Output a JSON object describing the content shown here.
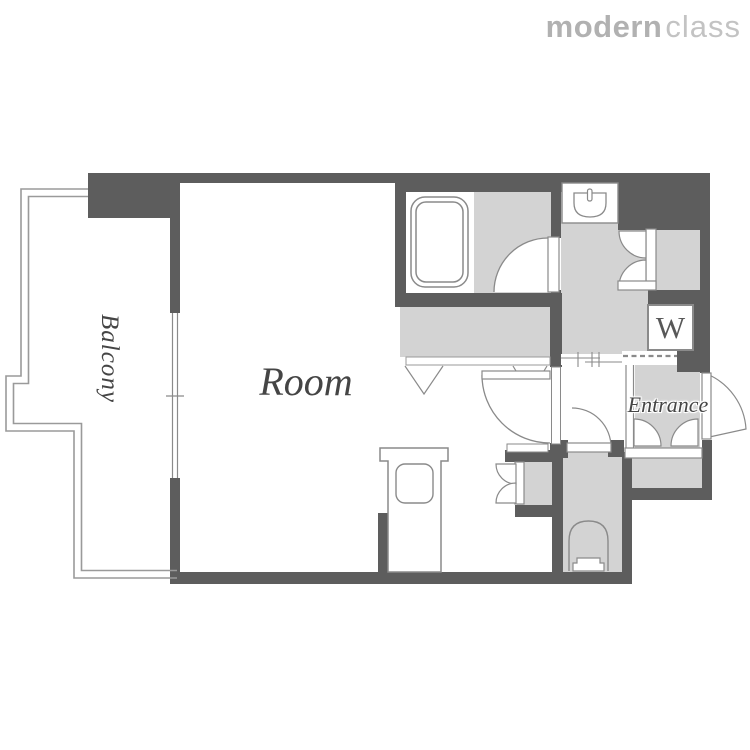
{
  "brand": {
    "bold": "modern",
    "light": "class"
  },
  "floorplan": {
    "labels": {
      "room": "Room",
      "balcony": "Balcony",
      "entrance": "Entrance",
      "washer": "W"
    },
    "colors": {
      "wall": "#5d5d5d",
      "floor": "#d3d3d3",
      "outline": "#8a8a8a",
      "railing": "#9a9a9a",
      "label_text": "#454545",
      "brand_bold": "#b1b1b1",
      "brand_light": "#c3c3c3"
    }
  }
}
